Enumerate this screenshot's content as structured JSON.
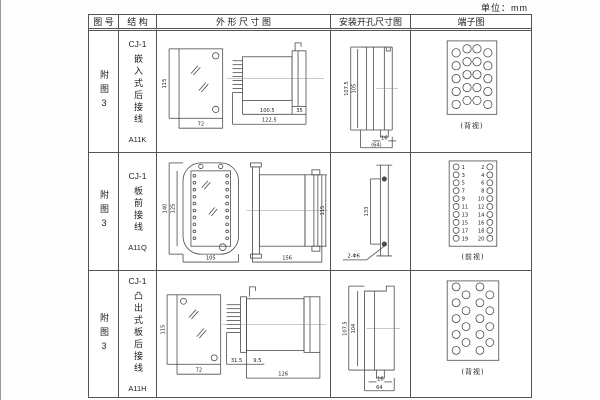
{
  "unit_label": "单位：mm",
  "headers": {
    "fig_no": "图 号",
    "structure": "结 构",
    "outline": "外 形 尺 寸 图",
    "mounting": "安装开孔尺寸图",
    "terminal": "端子图"
  },
  "rows": [
    {
      "fig_no": "附图3",
      "model": "CJ-1",
      "type_text": "嵌入式后接线",
      "code": "A11K",
      "dims": {
        "front_h": "115",
        "front_w": "72",
        "depth_body": "100.5",
        "depth_total": "122.5",
        "flange": "35"
      },
      "mount": {
        "v_outer": "107.5",
        "v_inner": "105",
        "slot": "16",
        "span": "(64)"
      },
      "terminal_caption": "(背视)"
    },
    {
      "fig_no": "附图3",
      "model": "CJ-1",
      "type_text": "板前接线",
      "code": "A11Q",
      "dims": {
        "front_h_outer": "140",
        "front_h_inner": "125",
        "front_w": "105",
        "depth": "156",
        "side_h": "115"
      },
      "mount": {
        "span": "133",
        "holes": "2-Φ6"
      },
      "terminal_caption": "(前视)",
      "t_left": [
        "1",
        "3",
        "5",
        "7",
        "9",
        "11",
        "13",
        "15",
        "17",
        "19"
      ],
      "t_right": [
        "2",
        "4",
        "6",
        "8",
        "10",
        "12",
        "14",
        "16",
        "18",
        "20"
      ]
    },
    {
      "fig_no": "附图3",
      "model": "CJ-1",
      "type_text": "凸出式板后接线",
      "code": "A11H",
      "dims": {
        "front_h": "115",
        "front_w": "72",
        "pins": "31.5",
        "gap": "9.5",
        "depth": "126"
      },
      "mount": {
        "v_outer": "107.5",
        "v_inner": "104",
        "slot": "16",
        "span": "64"
      },
      "terminal_caption": "(背视)"
    }
  ]
}
